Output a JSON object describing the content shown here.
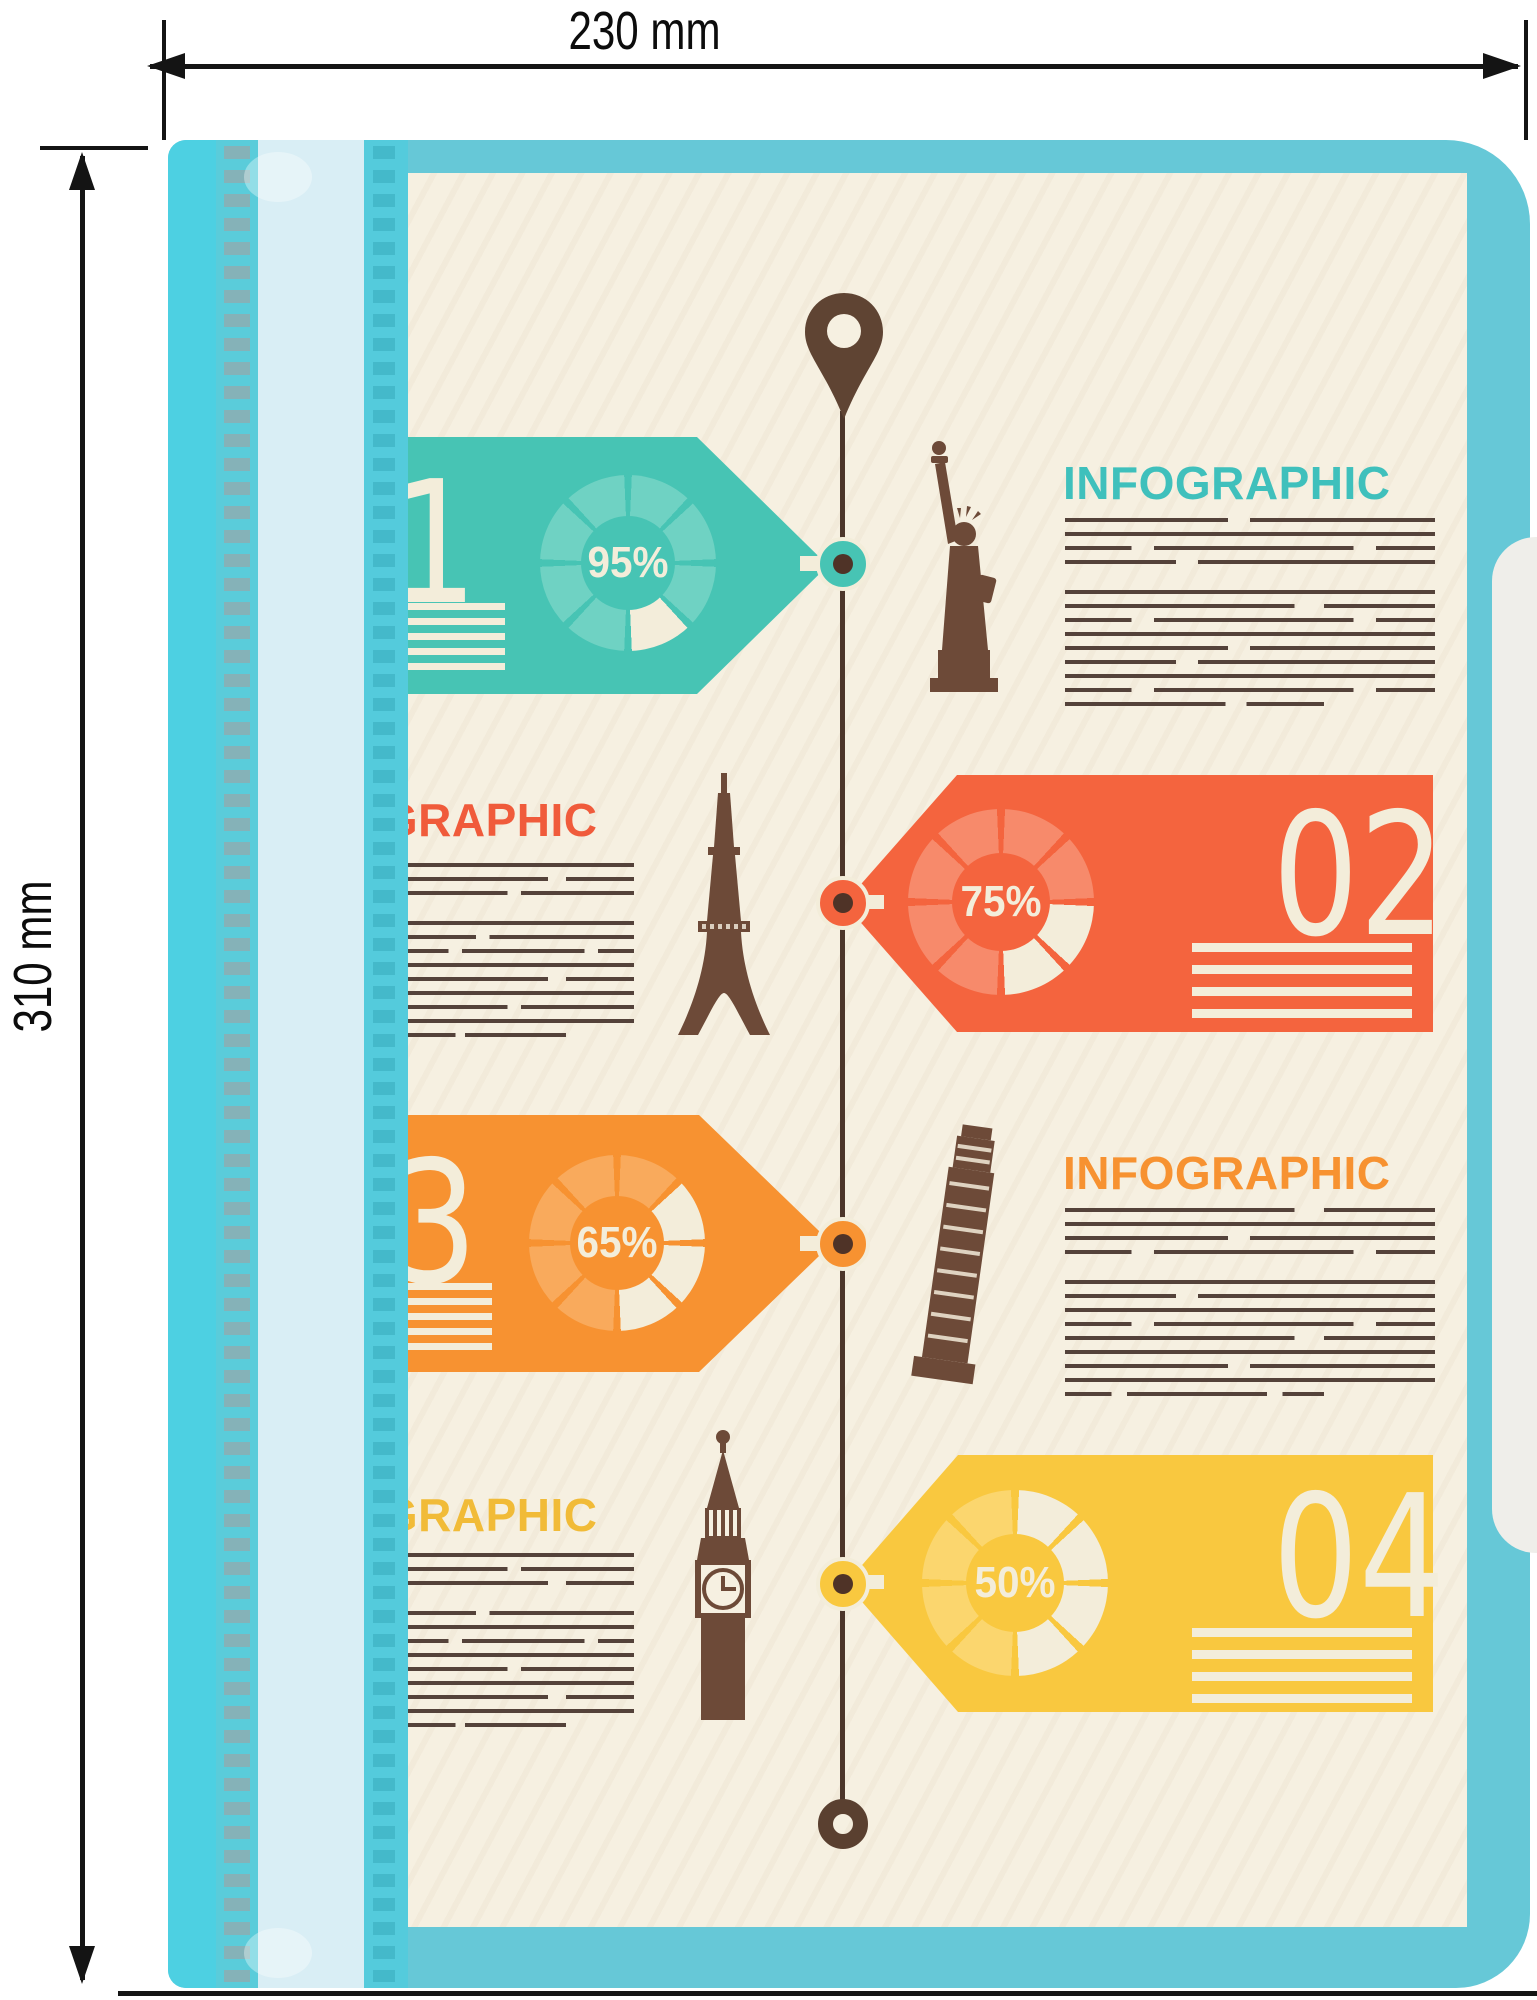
{
  "dimension_annotations": {
    "width_label": "230 mm",
    "height_label": "310 mm"
  },
  "folder": {
    "color": "#66c8d7",
    "edge_accent_color": "#4dd0e2",
    "spine_color": "#d9eef5"
  },
  "infographic": {
    "page_color": "#f6f0e1",
    "cream": "#f3edda",
    "text_line_color": "#54423a",
    "timeline": {
      "color": "#4c362a",
      "start_icon": "location-pin-icon",
      "end_icon": "ring-end-icon"
    },
    "sections": [
      {
        "number": "01",
        "percent": "95%",
        "pie_percent": 95,
        "heading": "INFOGRAPHIC",
        "color": "#47c4b4",
        "pie_light": "#6fd2c3",
        "landmark": "statue-of-liberty",
        "tag_points": "right"
      },
      {
        "number": "02",
        "percent": "75%",
        "pie_percent": 75,
        "heading": "INFOGRAPHIC",
        "color": "#f4643e",
        "pie_light": "#f78a6b",
        "landmark": "eiffel-tower",
        "tag_points": "left"
      },
      {
        "number": "03",
        "percent": "65%",
        "pie_percent": 65,
        "heading": "INFOGRAPHIC",
        "color": "#f79231",
        "pie_light": "#f9aa5c",
        "landmark": "leaning-tower-of-pisa",
        "tag_points": "right"
      },
      {
        "number": "04",
        "percent": "50%",
        "pie_percent": 50,
        "heading": "INFOGRAPHIC",
        "color": "#f9c83f",
        "pie_light": "#fbd66e",
        "landmark": "big-ben",
        "tag_points": "left"
      }
    ]
  }
}
